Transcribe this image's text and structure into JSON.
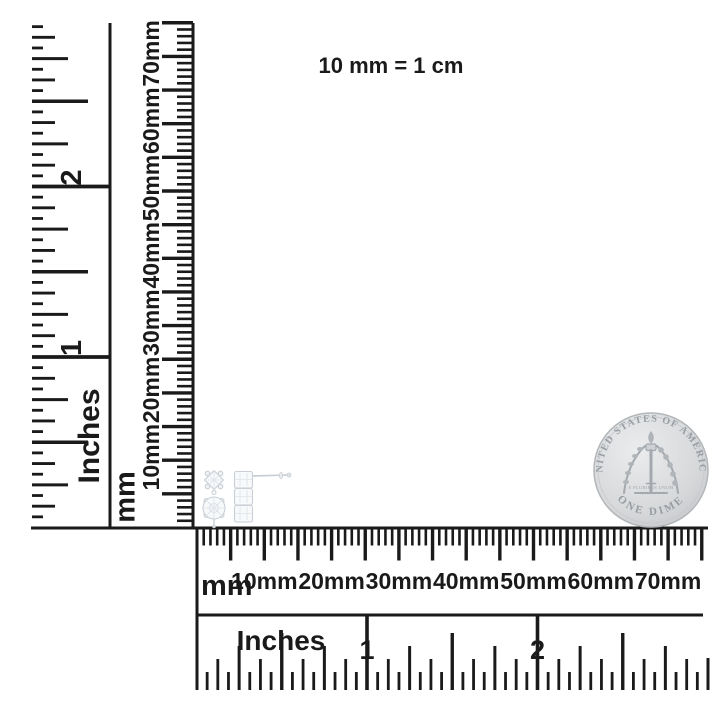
{
  "annotation": "10 mm = 1 cm",
  "colors": {
    "ruler_ink": "#1a1a1a",
    "coin_body": "#d6d8da",
    "coin_text": "#979da3",
    "earring_line": "#c9cfd5"
  },
  "rulers": {
    "vertical_inches": {
      "unit_label": "Inches",
      "numbers": [
        "1",
        "2"
      ],
      "range_inches": [
        0,
        3
      ],
      "ticks_per_inch": 16
    },
    "vertical_mm": {
      "unit_label": "mm",
      "labels": [
        "10mm",
        "20mm",
        "30mm",
        "40mm",
        "50mm",
        "60mm",
        "70mm"
      ],
      "range_mm": [
        0,
        75
      ],
      "minor_tick_mm": 1,
      "major_tick_mm": 5
    },
    "horizontal_mm": {
      "unit_label": "mm",
      "labels": [
        "10mm",
        "20mm",
        "30mm",
        "40mm",
        "50mm",
        "60mm",
        "70mm"
      ],
      "range_mm": [
        0,
        75
      ],
      "minor_tick_mm": 1,
      "major_tick_mm": 5
    },
    "horizontal_inches": {
      "unit_label": "Inches",
      "numbers": [
        "1",
        "2"
      ],
      "range_inches": [
        0,
        3
      ],
      "ticks_per_inch": 16
    }
  },
  "coin": {
    "name": "us-dime-reverse",
    "top_text": "UNITED STATES OF AMERICA",
    "bottom_text": "ONE DIME",
    "middle_text": "E PLURIBUS UNUM"
  },
  "objects": {
    "left_earring": "diamond-earring-front-view",
    "right_earring": "diamond-earring-side-view-with-post"
  }
}
